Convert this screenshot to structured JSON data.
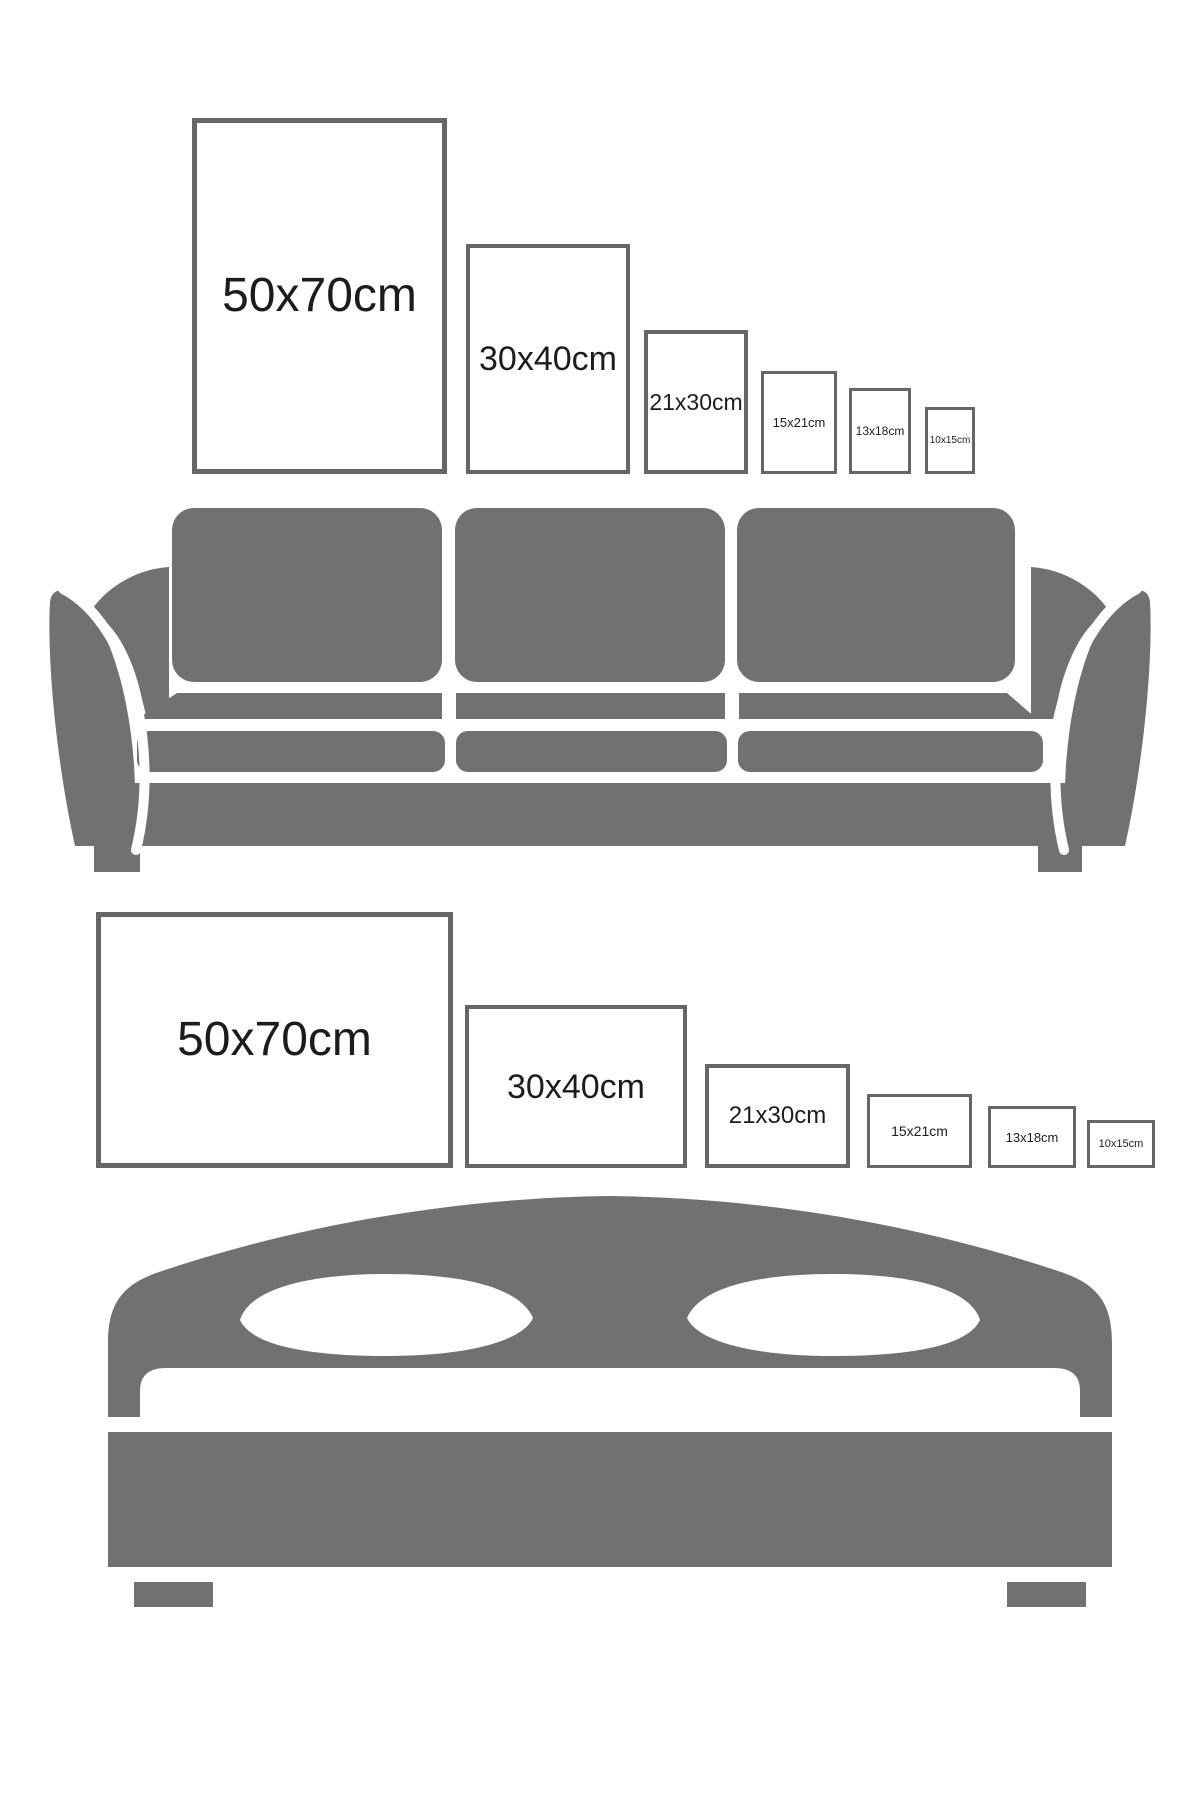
{
  "page": {
    "width": 1200,
    "height": 1800,
    "background": "#ffffff"
  },
  "colors": {
    "furniture_gray": "#717171",
    "frame_border": "#666666",
    "frame_fill": "#ffffff",
    "label_text": "#1c1c1c"
  },
  "icons": {
    "sofa": "sofa-icon",
    "bed": "bed-icon"
  },
  "poster_rows": [
    {
      "id": "portrait",
      "orientation": "portrait",
      "furniture": "sofa",
      "frames": [
        {
          "label": "50x70cm",
          "x": 192,
          "y": 118,
          "w": 255,
          "h": 356,
          "border": 5,
          "font": 48
        },
        {
          "label": "30x40cm",
          "x": 466,
          "y": 244,
          "w": 164,
          "h": 230,
          "border": 4,
          "font": 34
        },
        {
          "label": "21x30cm",
          "x": 644,
          "y": 330,
          "w": 104,
          "h": 144,
          "border": 4,
          "font": 23
        },
        {
          "label": "15x21cm",
          "x": 761,
          "y": 371,
          "w": 76,
          "h": 103,
          "border": 3,
          "font": 13
        },
        {
          "label": "13x18cm",
          "x": 849,
          "y": 388,
          "w": 62,
          "h": 86,
          "border": 3,
          "font": 12
        },
        {
          "label": "10x15cm",
          "x": 925,
          "y": 407,
          "w": 50,
          "h": 67,
          "border": 3,
          "font": 10
        }
      ]
    },
    {
      "id": "landscape",
      "orientation": "landscape",
      "furniture": "bed",
      "frames": [
        {
          "label": "50x70cm",
          "x": 96,
          "y": 912,
          "w": 357,
          "h": 256,
          "border": 5,
          "font": 48
        },
        {
          "label": "30x40cm",
          "x": 465,
          "y": 1005,
          "w": 222,
          "h": 163,
          "border": 4,
          "font": 34
        },
        {
          "label": "21x30cm",
          "x": 705,
          "y": 1064,
          "w": 145,
          "h": 104,
          "border": 4,
          "font": 24
        },
        {
          "label": "15x21cm",
          "x": 867,
          "y": 1094,
          "w": 105,
          "h": 74,
          "border": 3,
          "font": 14
        },
        {
          "label": "13x18cm",
          "x": 988,
          "y": 1106,
          "w": 88,
          "h": 62,
          "border": 3,
          "font": 13
        },
        {
          "label": "10x15cm",
          "x": 1087,
          "y": 1120,
          "w": 68,
          "h": 48,
          "border": 3,
          "font": 11
        }
      ]
    }
  ]
}
